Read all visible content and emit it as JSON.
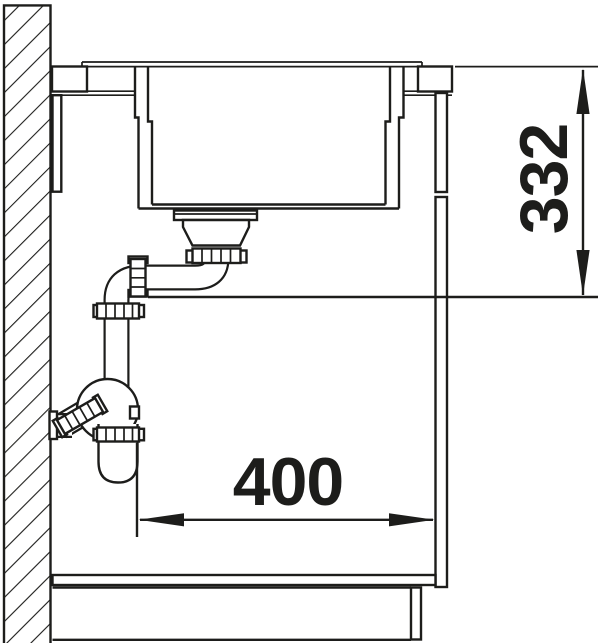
{
  "drawing": {
    "type": "sink-installation-section",
    "background": "#ffffff",
    "line_color": "#1d1d1b",
    "dimensions": {
      "depth_below_worktop": {
        "label": "332",
        "orientation": "vertical"
      },
      "clearance_to_front": {
        "label": "400",
        "orientation": "horizontal"
      }
    }
  }
}
